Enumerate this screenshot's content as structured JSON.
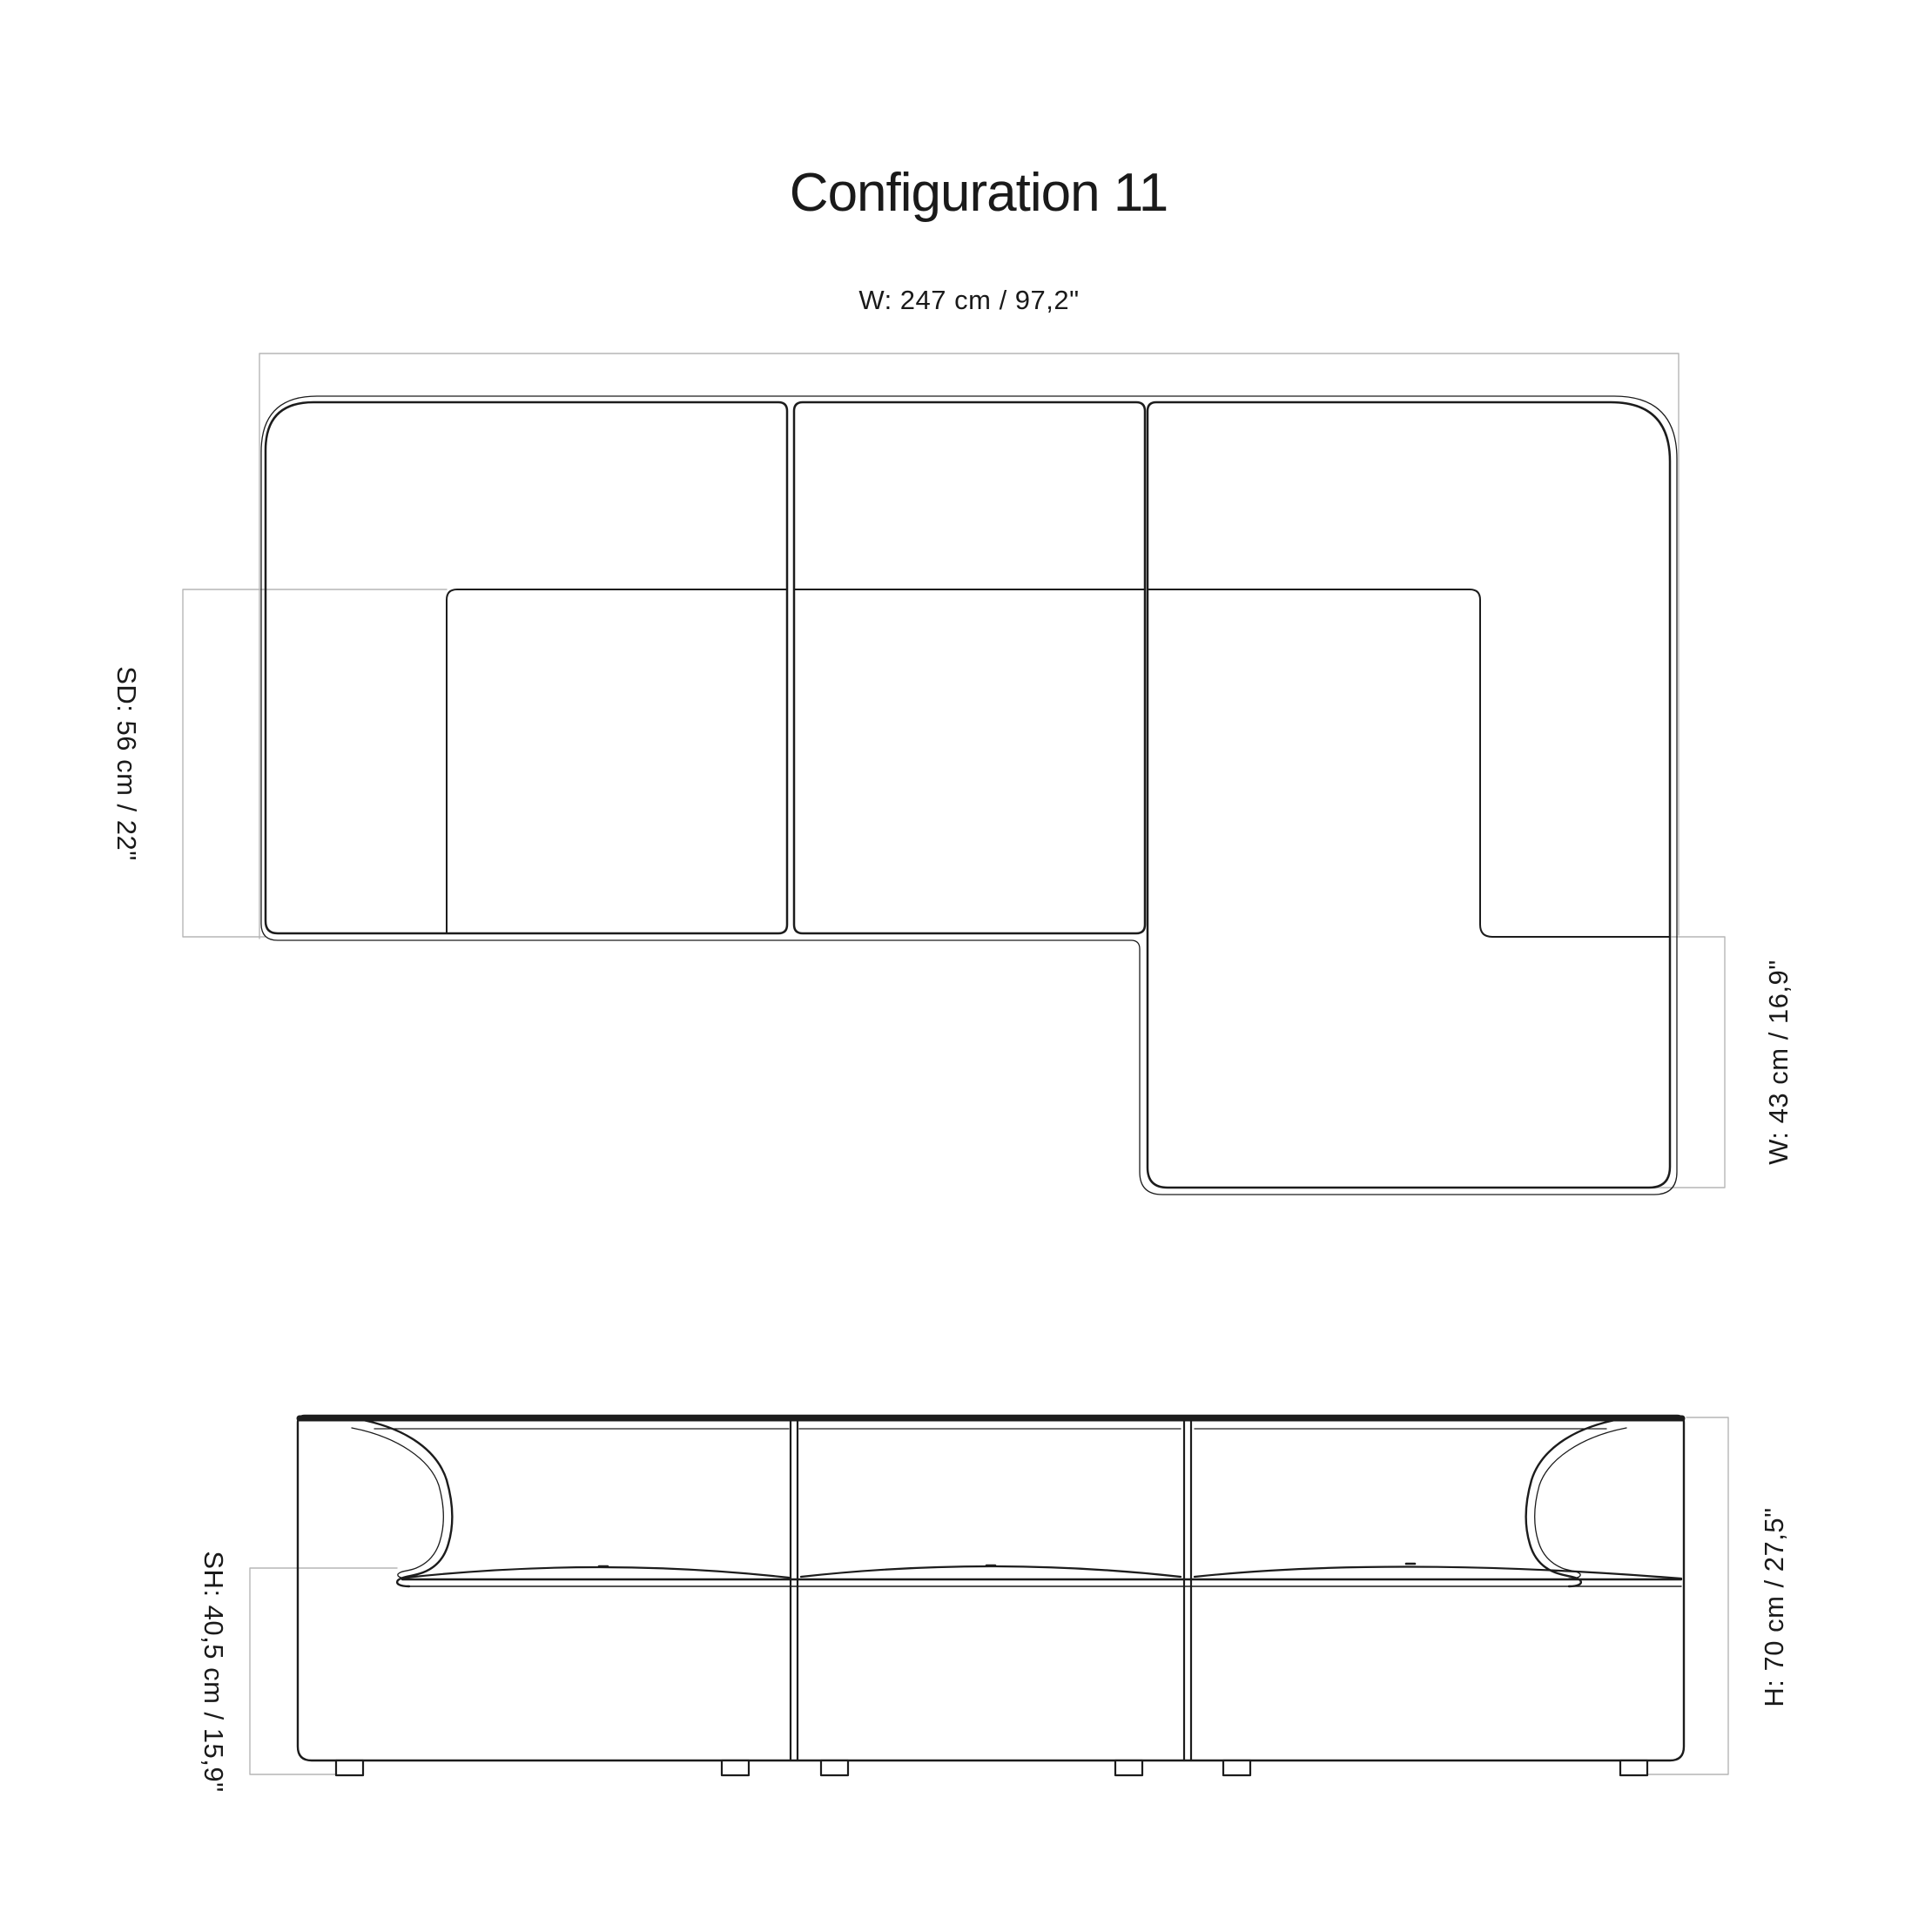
{
  "title": "Configuration 11",
  "views": {
    "plan": {
      "name": "top view of modular sofa with chaise",
      "label_overall_width": "W: 247 cm / 97,2\"",
      "label_seat_depth": "SD: 56 cm / 22\"",
      "label_chaise_depth": "W: 43 cm / 16,9\"",
      "dimensions": {
        "overall_width_cm": 247,
        "overall_width_in": 97.2,
        "seat_depth_cm": 56,
        "seat_depth_in": 22,
        "chaise_depth_cm": 43,
        "chaise_depth_in": 16.9
      },
      "module_count": 3
    },
    "front": {
      "name": "front elevation of modular sofa",
      "label_seat_height": "SH: 40,5 cm / 15,9\"",
      "label_height": "H: 70 cm / 27,5\"",
      "dimensions": {
        "seat_height_cm": 40.5,
        "seat_height_in": 15.9,
        "height_cm": 70,
        "height_in": 27.5
      },
      "leg_count": 6
    }
  },
  "colors": {
    "line": "#1c1c1c",
    "dimension_line": "#b6b6b6",
    "text": "#1a1a1a",
    "background": "#ffffff"
  }
}
